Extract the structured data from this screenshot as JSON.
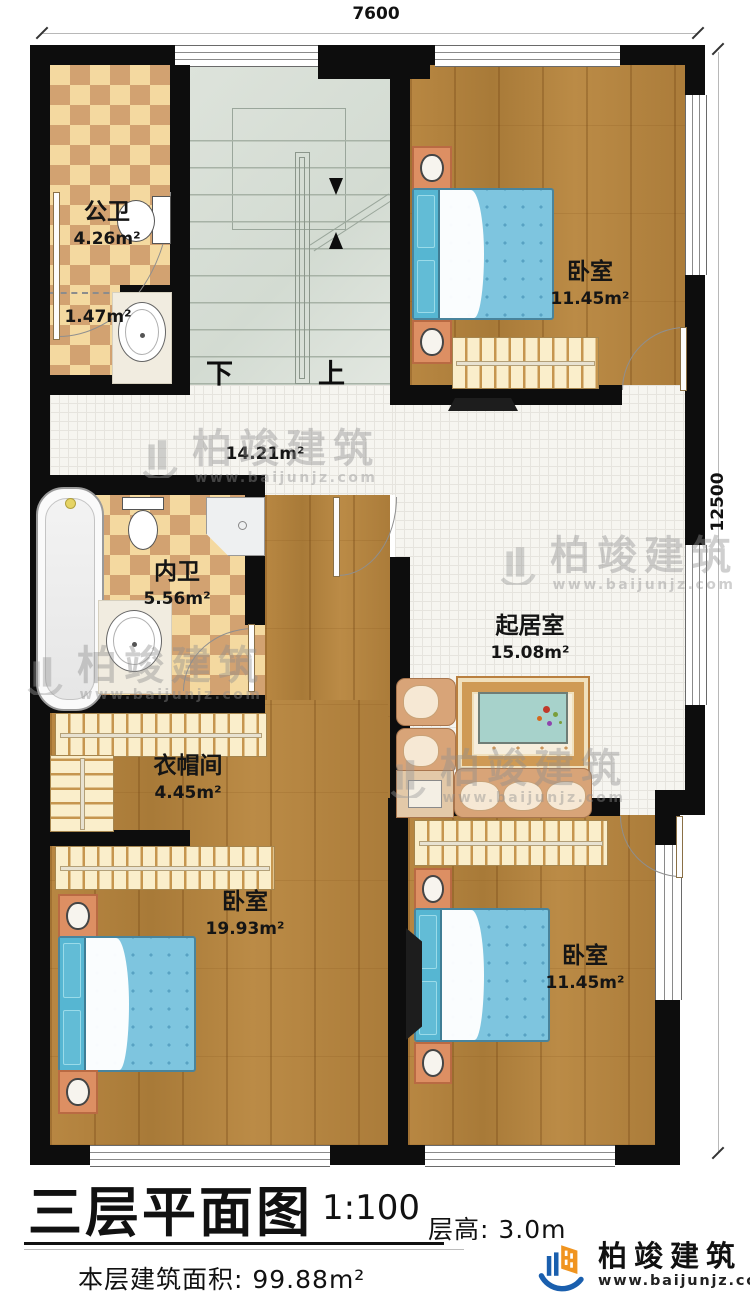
{
  "plan": {
    "dimensions": {
      "top": "7600",
      "right": "12500"
    },
    "rooms": {
      "public_bath": {
        "name": "公卫",
        "area": "4.26m²"
      },
      "bath_lobby": {
        "area": "1.47m²"
      },
      "bedroom_top_right": {
        "name": "卧室",
        "area": "11.45m²"
      },
      "hallway": {
        "area": "14.21m²"
      },
      "master_bath": {
        "name": "内卫",
        "area": "5.56m²"
      },
      "living_room": {
        "name": "起居室",
        "area": "15.08m²"
      },
      "cloakroom": {
        "name": "衣帽间",
        "area": "4.45m²"
      },
      "bedroom_bottom_left": {
        "name": "卧室",
        "area": "19.93m²"
      },
      "bedroom_bottom_right": {
        "name": "卧室",
        "area": "11.45m²"
      }
    },
    "stairs": {
      "down_label": "下",
      "up_label": "上"
    }
  },
  "title_block": {
    "title": "三层平面图",
    "scale": "1:100",
    "floor_height": "层高: 3.0m",
    "floor_area": "本层建筑面积: 99.88m²"
  },
  "brand": {
    "name": "柏竣建筑",
    "website": "www.baijunjz.com"
  },
  "watermark": {
    "name": "柏竣建筑",
    "website": "www.baijunjz.com"
  },
  "colors": {
    "wall": "#0d0d0d",
    "wood": "#b2813e",
    "tile_light": "#f4d9a0",
    "tile_dark": "#d2a271",
    "stairs": "#dce3db",
    "bed": "#7ec5df",
    "logo_blue": "#1a5fae",
    "logo_orange": "#f0941f"
  }
}
